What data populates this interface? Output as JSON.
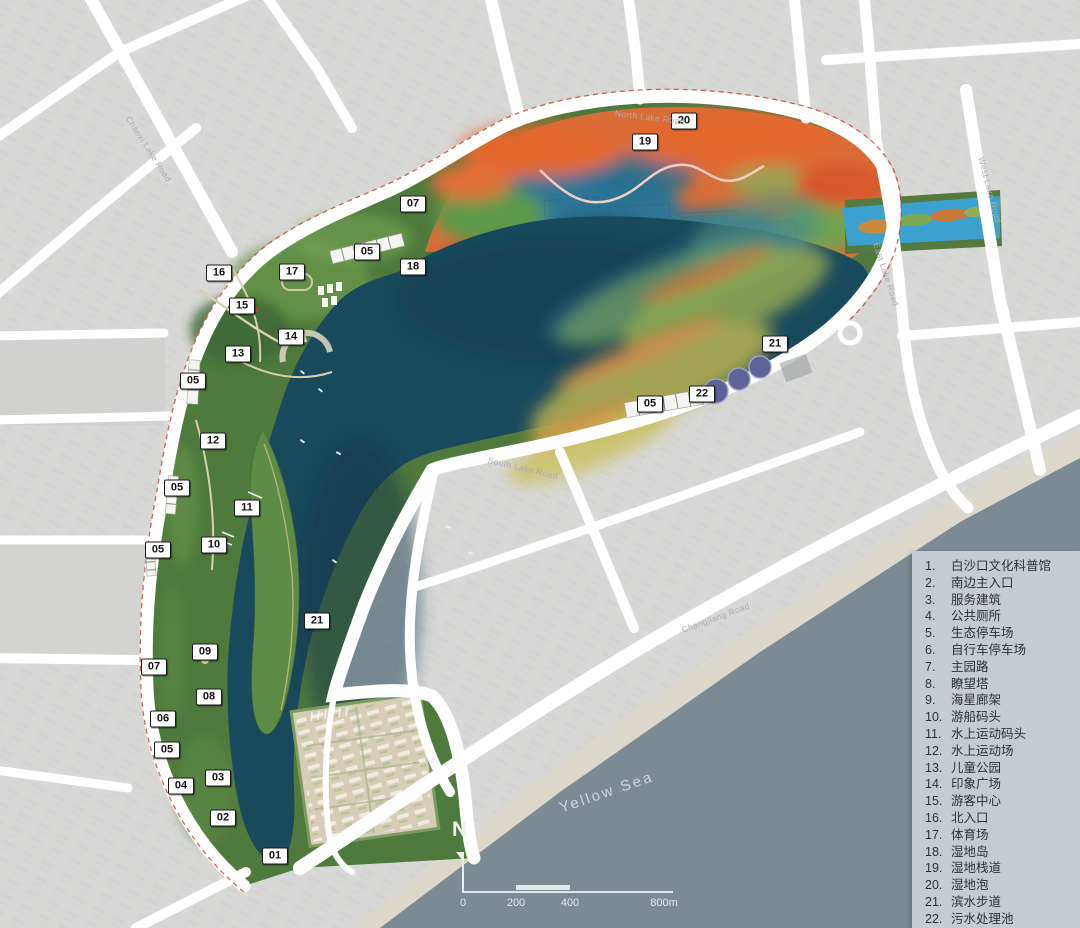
{
  "legend": {
    "items": [
      {
        "num": "1.",
        "label": "白沙口文化科普馆"
      },
      {
        "num": "2.",
        "label": "南边主入口"
      },
      {
        "num": "3.",
        "label": "服务建筑"
      },
      {
        "num": "4.",
        "label": "公共厕所"
      },
      {
        "num": "5.",
        "label": "生态停车场"
      },
      {
        "num": "6.",
        "label": "自行车停车场"
      },
      {
        "num": "7.",
        "label": "主园路"
      },
      {
        "num": "8.",
        "label": "瞭望塔"
      },
      {
        "num": "9.",
        "label": "海星廊架"
      },
      {
        "num": "10.",
        "label": "游船码头"
      },
      {
        "num": "11.",
        "label": "水上运动码头"
      },
      {
        "num": "12.",
        "label": "水上运动场"
      },
      {
        "num": "13.",
        "label": "儿童公园"
      },
      {
        "num": "14.",
        "label": "印象广场"
      },
      {
        "num": "15.",
        "label": "游客中心"
      },
      {
        "num": "16.",
        "label": "北入口"
      },
      {
        "num": "17.",
        "label": "体育场"
      },
      {
        "num": "18.",
        "label": "湿地岛"
      },
      {
        "num": "19.",
        "label": "湿地栈道"
      },
      {
        "num": "20.",
        "label": "湿地泡"
      },
      {
        "num": "21.",
        "label": "滨水步道"
      },
      {
        "num": "22.",
        "label": "污水处理池"
      }
    ]
  },
  "map": {
    "markers": [
      {
        "label": "20",
        "x": 684,
        "y": 121
      },
      {
        "label": "19",
        "x": 645,
        "y": 142
      },
      {
        "label": "07",
        "x": 413,
        "y": 204
      },
      {
        "label": "05",
        "x": 367,
        "y": 252
      },
      {
        "label": "18",
        "x": 413,
        "y": 267
      },
      {
        "label": "16",
        "x": 219,
        "y": 273
      },
      {
        "label": "17",
        "x": 292,
        "y": 272
      },
      {
        "label": "15",
        "x": 242,
        "y": 306
      },
      {
        "label": "14",
        "x": 291,
        "y": 337
      },
      {
        "label": "13",
        "x": 238,
        "y": 354
      },
      {
        "label": "05",
        "x": 193,
        "y": 381
      },
      {
        "label": "12",
        "x": 213,
        "y": 441
      },
      {
        "label": "05",
        "x": 177,
        "y": 488
      },
      {
        "label": "11",
        "x": 247,
        "y": 508
      },
      {
        "label": "10",
        "x": 214,
        "y": 545
      },
      {
        "label": "05",
        "x": 158,
        "y": 550
      },
      {
        "label": "21",
        "x": 317,
        "y": 621
      },
      {
        "label": "09",
        "x": 205,
        "y": 652
      },
      {
        "label": "07",
        "x": 154,
        "y": 667
      },
      {
        "label": "08",
        "x": 209,
        "y": 697
      },
      {
        "label": "06",
        "x": 163,
        "y": 719
      },
      {
        "label": "05",
        "x": 167,
        "y": 750
      },
      {
        "label": "03",
        "x": 218,
        "y": 778
      },
      {
        "label": "04",
        "x": 181,
        "y": 786
      },
      {
        "label": "02",
        "x": 223,
        "y": 818
      },
      {
        "label": "01",
        "x": 275,
        "y": 856
      },
      {
        "label": "21",
        "x": 775,
        "y": 344
      },
      {
        "label": "22",
        "x": 702,
        "y": 394
      },
      {
        "label": "05",
        "x": 650,
        "y": 404
      }
    ],
    "road_labels": [
      {
        "text": "Chaoxi Lake Road",
        "x": 128,
        "y": 112,
        "rotate": 57
      },
      {
        "text": "North Lake Road",
        "x": 615,
        "y": 108,
        "rotate": 7
      },
      {
        "text": "West Lake Road",
        "x": 981,
        "y": 152,
        "rotate": 75
      },
      {
        "text": "East Lake Road",
        "x": 876,
        "y": 238,
        "rotate": 72
      },
      {
        "text": "South Lake Road",
        "x": 488,
        "y": 455,
        "rotate": 13
      },
      {
        "text": "Changjiang Road",
        "x": 682,
        "y": 625,
        "rotate": -20
      }
    ],
    "sea_label": {
      "text": "Yellow Sea",
      "x": 560,
      "y": 800,
      "rotate": -19
    },
    "north_label": "N",
    "scalebar": {
      "ticks": [
        {
          "label": "0",
          "x": 463
        },
        {
          "label": "200",
          "x": 516
        },
        {
          "label": "400",
          "x": 570
        },
        {
          "label": "800m",
          "x": 664
        }
      ]
    }
  },
  "colors": {
    "city_base": "#d8d8d7",
    "road": "#ffffff",
    "sea": "#7b8a93",
    "beach": "#ddd8cc",
    "park_green": "#4e7a3d",
    "lake": "#19495c",
    "wetland_orange": "#d96d38",
    "stream_blue": "#3ba2cf",
    "boundary_red": "#c84a3e",
    "pond_purple": "#5e6295",
    "legend_bg": "#c6cbd1",
    "marker_bg": "#fdfdfd",
    "marker_border": "#1a1a1a"
  }
}
